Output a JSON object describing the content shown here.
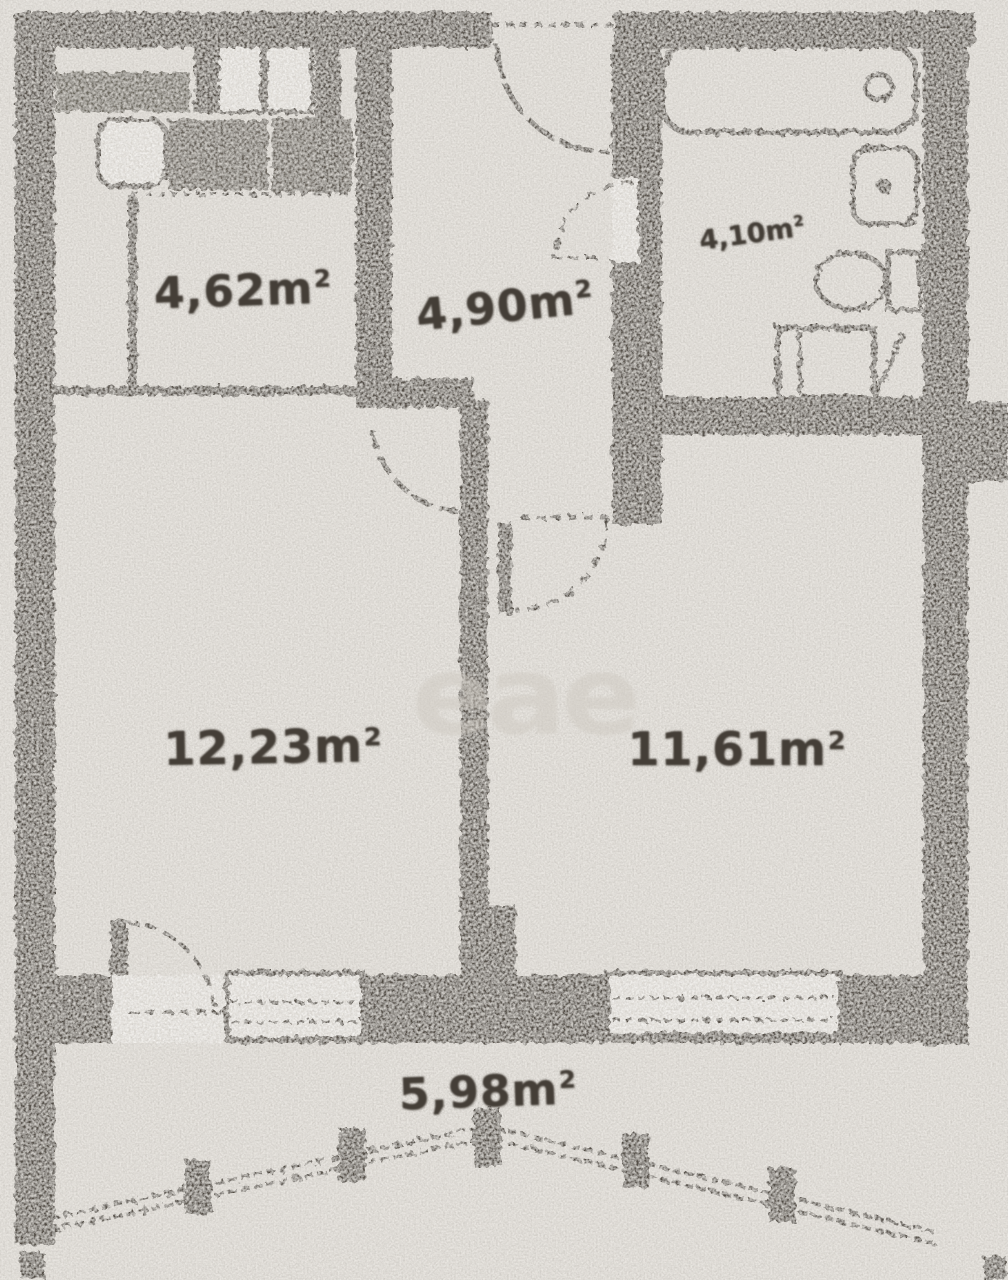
{
  "rooms": [
    {
      "id": "room-top-left",
      "area_value": "4,62",
      "area_unit": "m",
      "area_sup": "2"
    },
    {
      "id": "room-top-middle",
      "area_value": "4,90",
      "area_unit": "m",
      "area_sup": "2"
    },
    {
      "id": "room-top-right",
      "area_value": "4,10",
      "area_unit": "m",
      "area_sup": "2"
    },
    {
      "id": "room-left",
      "area_value": "12,23",
      "area_unit": "m",
      "area_sup": "2"
    },
    {
      "id": "room-right",
      "area_value": "11,61",
      "area_unit": "m",
      "area_sup": "2"
    },
    {
      "id": "room-balcony",
      "area_value": "5,98",
      "area_unit": "m",
      "area_sup": "2"
    }
  ],
  "watermark": {
    "text": "еае"
  },
  "colors": {
    "paper": "#e9e6e1",
    "ink": "#4b453d",
    "label_ink": "#443e37",
    "watermark": "#cfcac2"
  }
}
